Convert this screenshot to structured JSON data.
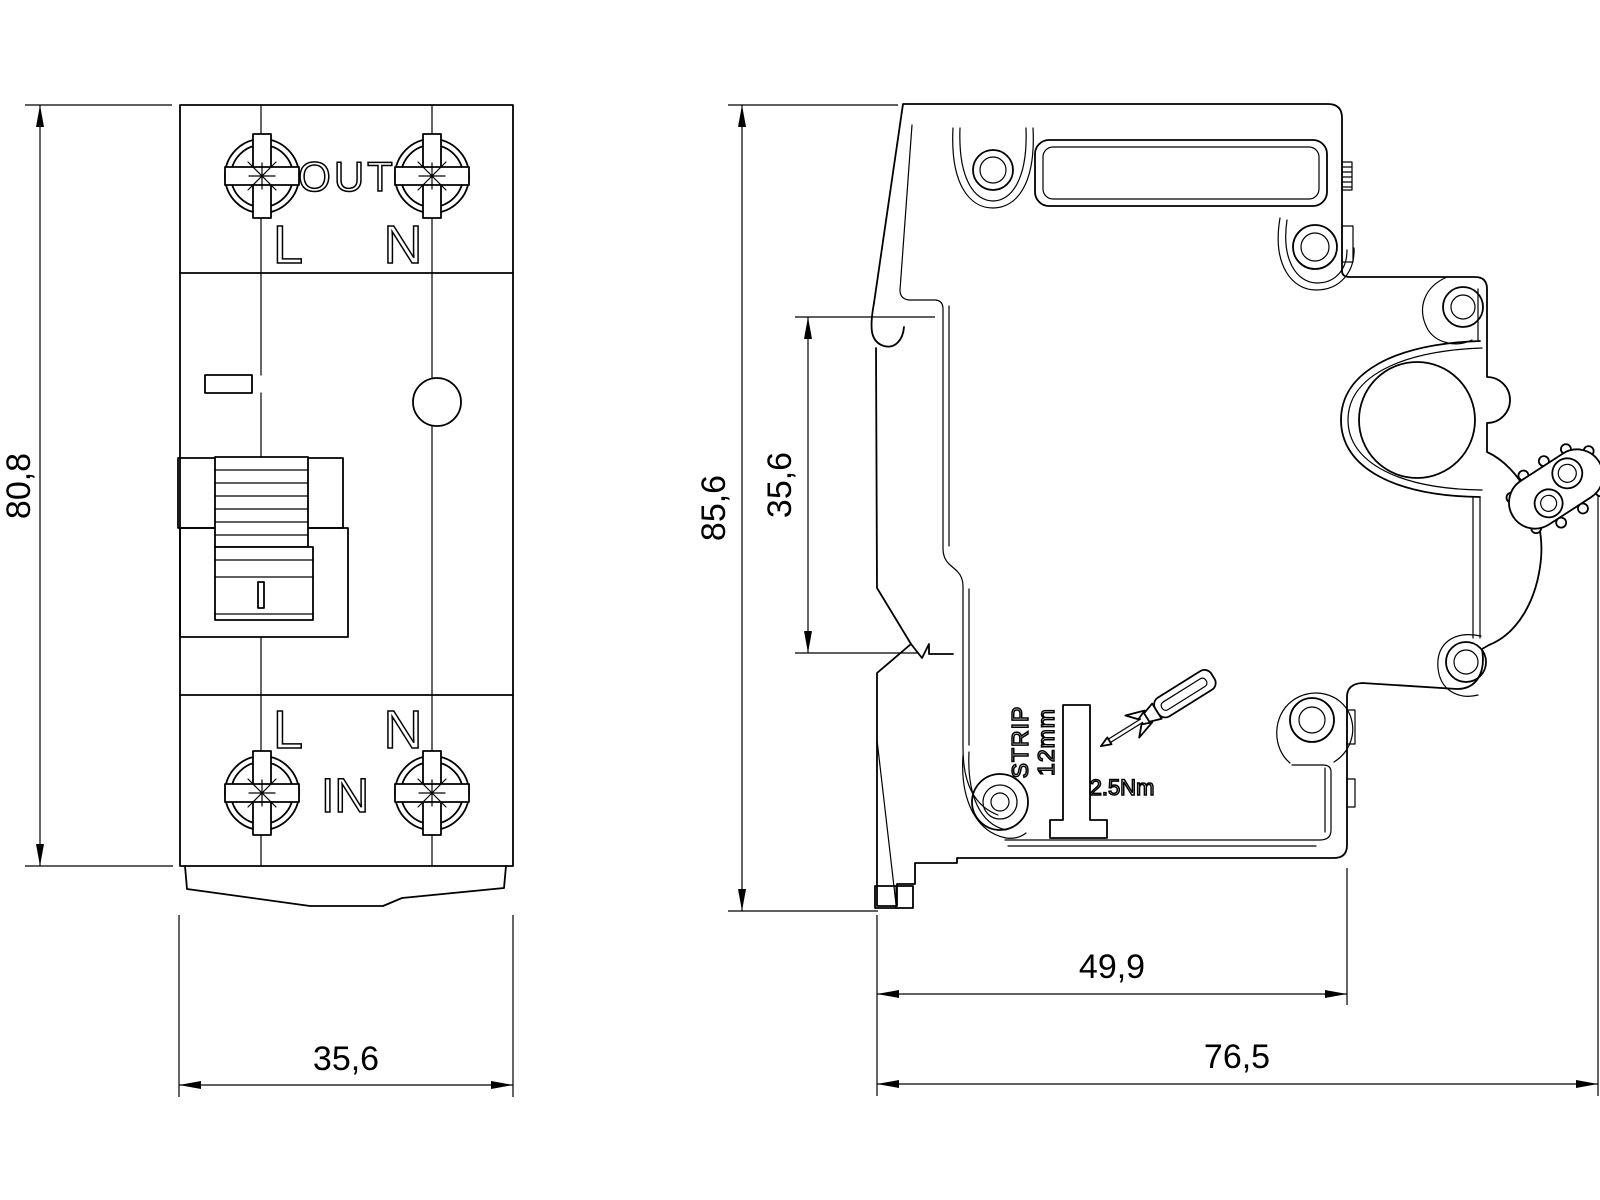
{
  "drawing": {
    "colors": {
      "line": "#000000",
      "background": "#ffffff"
    },
    "front_view": {
      "terminal_out": "OUT",
      "terminal_in": "IN",
      "line_label_top": "L",
      "neutral_label_top": "N",
      "line_label_bottom": "L",
      "neutral_label_bottom": "N",
      "dim_height": "80,8",
      "dim_width": "35,6"
    },
    "side_view": {
      "dim_height": "85,6",
      "dim_rail_recess": "35,6",
      "dim_depth_rail": "49,9",
      "dim_depth_total": "76,5",
      "strip_gauge_line1": "12mm",
      "strip_gauge_line2": "STRIP",
      "torque": "2.5Nm"
    }
  }
}
